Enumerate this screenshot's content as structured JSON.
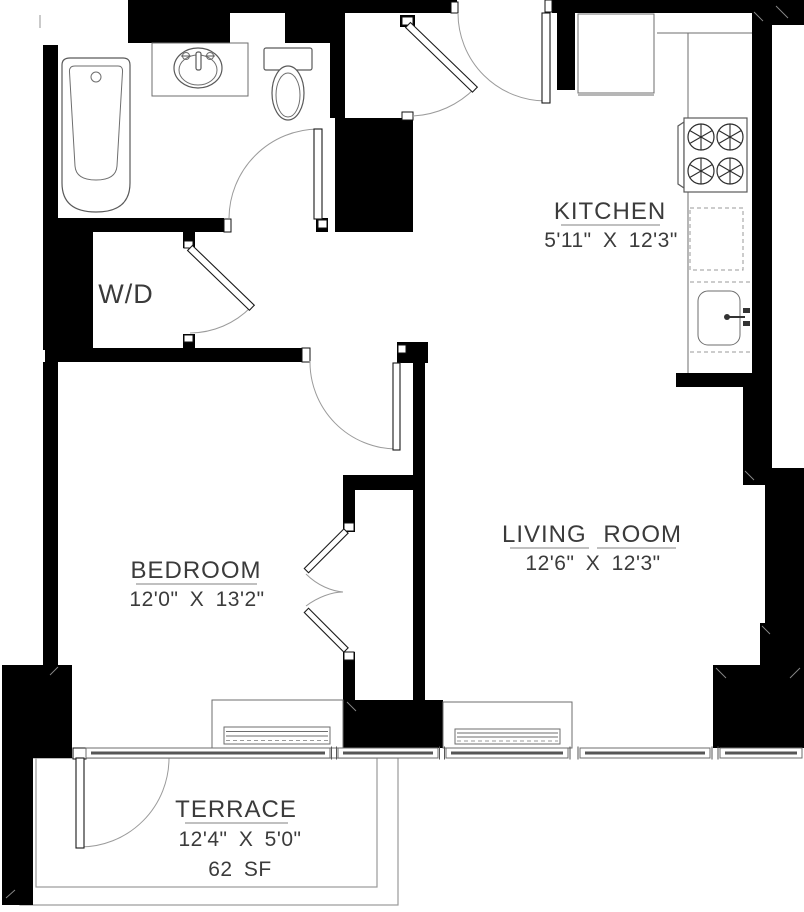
{
  "plan": {
    "rooms": {
      "kitchen": {
        "label": "KITCHEN",
        "dims": "5'11\" X 12'3\""
      },
      "living_room": {
        "label": "LIVING ROOM",
        "dims": "12'6\" X 12'3\""
      },
      "bedroom": {
        "label": "BEDROOM",
        "dims": "12'0\" X 13'2\""
      },
      "terrace": {
        "label": "TERRACE",
        "dims": "12'4\" X 5'0\"",
        "area": "62 SF"
      },
      "laundry": {
        "label": "W/D"
      }
    },
    "colors": {
      "wall": "#000000",
      "line": "#6e6e6e",
      "text": "#3b3b3b"
    }
  }
}
